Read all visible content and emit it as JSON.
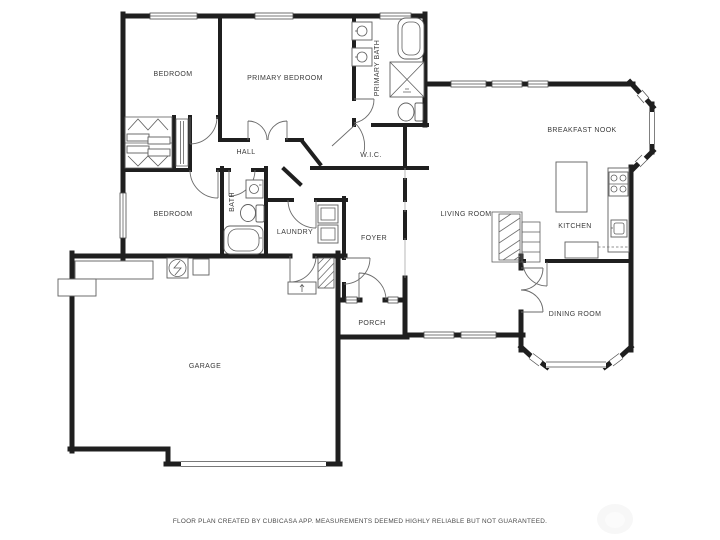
{
  "page": {
    "background_color": "#ffffff",
    "wall_color": "#1f1f1f",
    "fixture_line_color": "#5f5f5f",
    "label_color": "#3a3a3a"
  },
  "floor_plan": {
    "rooms": {
      "bedroom_top": {
        "label": "BEDROOM"
      },
      "primary_bedroom": {
        "label": "PRIMARY BEDROOM"
      },
      "primary_bath": {
        "label": "PRIMARY BATH"
      },
      "hall": {
        "label": "HALL"
      },
      "wic": {
        "label": "W.I.C."
      },
      "breakfast_nook": {
        "label": "BREAKFAST NOOK"
      },
      "bedroom_left": {
        "label": "BEDROOM"
      },
      "bath": {
        "label": "BATH"
      },
      "laundry": {
        "label": "LAUNDRY"
      },
      "foyer": {
        "label": "FOYER"
      },
      "living_room": {
        "label": "LIVING ROOM"
      },
      "kitchen": {
        "label": "KITCHEN"
      },
      "dining_room": {
        "label": "DINING ROOM"
      },
      "porch": {
        "label": "PORCH"
      },
      "garage": {
        "label": "GARAGE"
      }
    },
    "fixtures": [
      "bathtub",
      "shower",
      "toilet",
      "sink-vanity",
      "sliding-closet-doors",
      "hanging-rail",
      "linen-shelves",
      "washer-dryer",
      "kitchen-island",
      "stove",
      "kitchen-sink",
      "counter",
      "fireplace",
      "shelving",
      "water-heater",
      "workbench",
      "entry-step",
      "stair-hatch",
      "bay-window",
      "garage-door",
      "windows",
      "doors"
    ]
  },
  "footer": {
    "disclaimer": "FLOOR PLAN CREATED BY CUBICASA APP. MEASUREMENTS DEEMED HIGHLY RELIABLE BUT NOT GUARANTEED."
  },
  "watermark": {
    "icon": "cubicasa-logo"
  }
}
